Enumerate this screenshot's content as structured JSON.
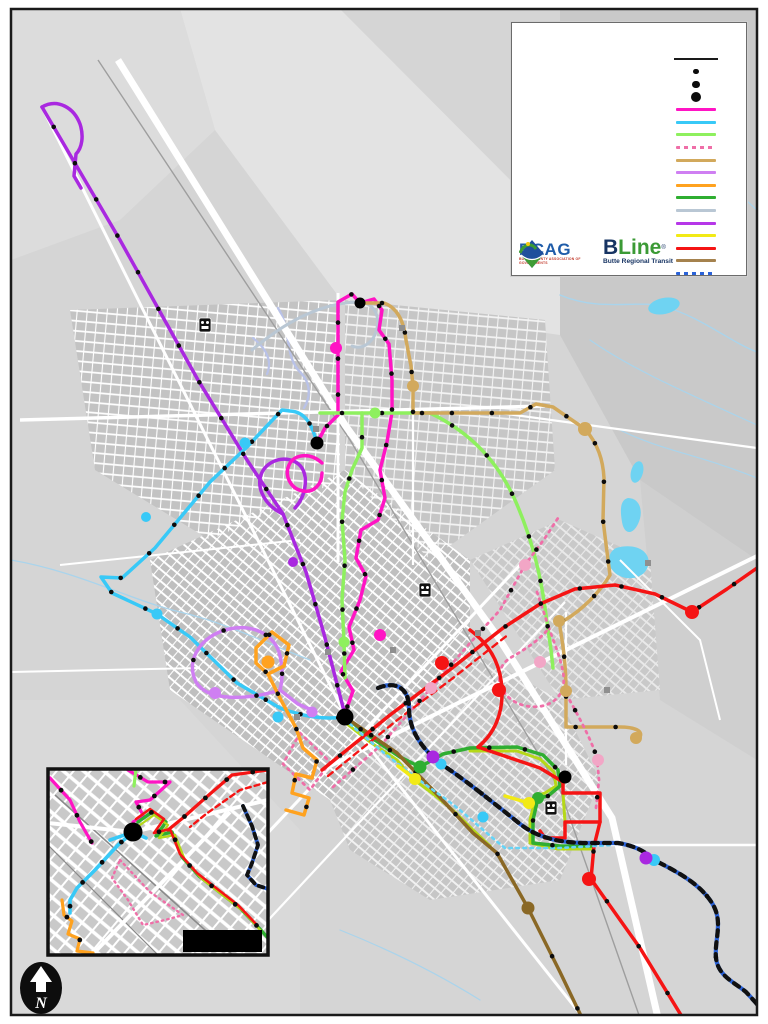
{
  "page": {
    "border_color": "#1a1a1a",
    "background": "#ffffff",
    "map_background": "#d5d5d5"
  },
  "legend": {
    "black_line": {
      "name": "black-route-line",
      "color": "#1a1a1a"
    },
    "stop_dots": [
      {
        "name": "small-stop-dot",
        "r": 2.6
      },
      {
        "name": "medium-stop-dot",
        "r": 3.8
      },
      {
        "name": "large-stop-dot",
        "r": 5.4
      }
    ],
    "route_swatches": [
      {
        "name": "magenta-route",
        "color": "#ff14c4",
        "dash": ""
      },
      {
        "name": "cyan-route",
        "color": "#38c9f7",
        "dash": ""
      },
      {
        "name": "light-green-route",
        "color": "#8ef05e",
        "dash": ""
      },
      {
        "name": "pink-dashed-route",
        "color": "#ef6fa8",
        "dash": "3,4"
      },
      {
        "name": "tan-route",
        "color": "#d2a95c",
        "dash": ""
      },
      {
        "name": "violet-route",
        "color": "#cf7ff2",
        "dash": ""
      },
      {
        "name": "orange-route",
        "color": "#ffa21f",
        "dash": ""
      },
      {
        "name": "green-route",
        "color": "#2fae31",
        "dash": ""
      },
      {
        "name": "blue-gray-route",
        "color": "#b9c7d4",
        "dash": ""
      },
      {
        "name": "purple-route",
        "color": "#b637e8",
        "dash": ""
      },
      {
        "name": "yellow-route",
        "color": "#f2ea16",
        "dash": ""
      },
      {
        "name": "red-route",
        "color": "#f51414",
        "dash": ""
      },
      {
        "name": "dark-tan-route",
        "color": "#a5824e",
        "dash": ""
      },
      {
        "name": "blue-black-dashed-route",
        "color": "#2a62d8",
        "dash": "4,4"
      }
    ]
  },
  "logos": {
    "bcag": {
      "title": "BCAG",
      "subtitle": "BUTTE COUNTY ASSOCIATION OF GOVERNMENTS",
      "title_color": "#1f5ca9",
      "icon_blue": "#1f4f9c",
      "icon_green": "#3f9c35"
    },
    "bline": {
      "b": "B",
      "line": "Line",
      "reg": "®",
      "subtitle": "Butte Regional Transit",
      "navy": "#173463",
      "green": "#3b9a35"
    }
  },
  "north_arrow": {
    "label": "N"
  },
  "colors": {
    "magenta": "#ff14c4",
    "cyan": "#38c9f7",
    "cyanDotted": "#66d4f7",
    "lightGreen": "#8ef05e",
    "pinkDash": "#ef6fa8",
    "pinkLight": "#f2a6c6",
    "tan": "#d2a95c",
    "violet": "#cf7ff2",
    "orange": "#ffa21f",
    "green": "#2fae31",
    "blueGray": "#b9c7d4",
    "purple": "#a928e0",
    "yellow": "#f2ea16",
    "red": "#f51414",
    "brown": "#8a6825",
    "blue": "#2a62d8",
    "yellowGreen": "#b5d818",
    "water": "#6fd3f2",
    "creek": "#a9d4ec",
    "stream": "#b9c2e8",
    "road": "#ffffff",
    "rail": "#9e9e9e",
    "stop": "#0c0c0c",
    "hub": "#000000",
    "graySquare": "#8f8f8f",
    "scaleBar": "#000000"
  },
  "icons": {
    "highway_shield": "highway-shield-icon",
    "north_arrow": "north-arrow-icon",
    "scale_bar": "scale-bar"
  }
}
